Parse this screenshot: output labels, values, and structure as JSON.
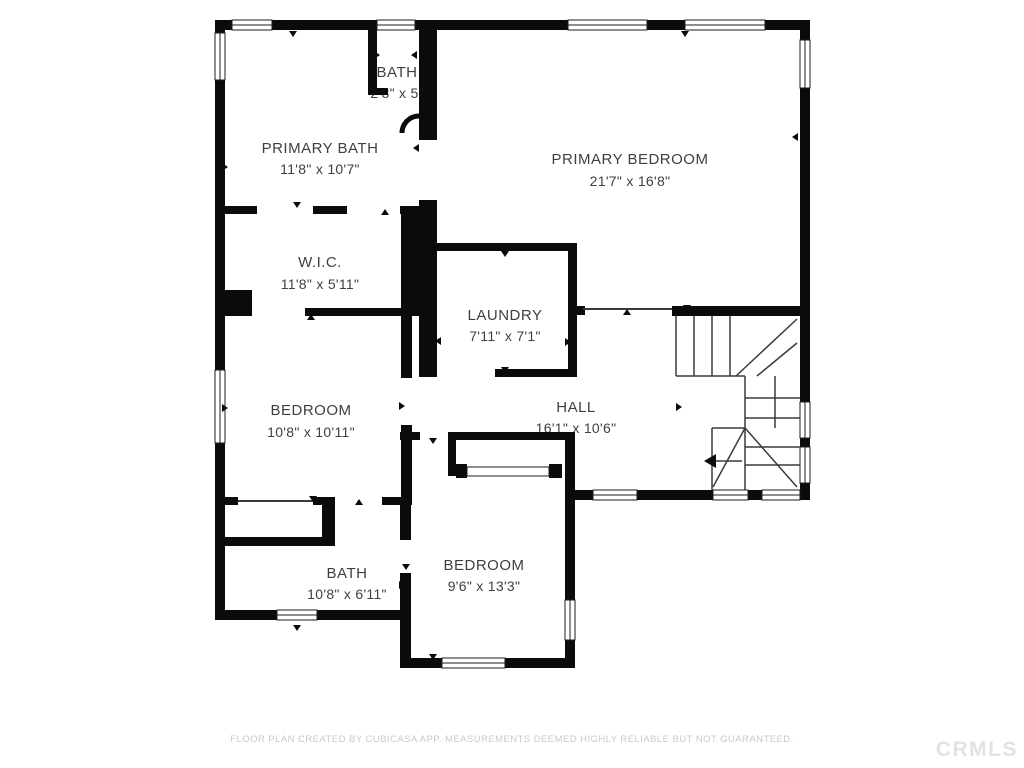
{
  "floor_plan": {
    "rooms": [
      {
        "name": "BATH",
        "dims": "2'8\" x 5'"
      },
      {
        "name": "PRIMARY BATH",
        "dims": "11'8\" x 10'7\""
      },
      {
        "name": "PRIMARY BEDROOM",
        "dims": "21'7\" x 16'8\""
      },
      {
        "name": "W.I.C.",
        "dims": "11'8\" x 5'11\""
      },
      {
        "name": "LAUNDRY",
        "dims": "7'11\" x 7'1\""
      },
      {
        "name": "BEDROOM",
        "dims": "10'8\" x 10'11\""
      },
      {
        "name": "HALL",
        "dims": "16'1\" x 10'6\""
      },
      {
        "name": "BATH",
        "dims": "10'8\" x 6'11\""
      },
      {
        "name": "BEDROOM",
        "dims": "9'6\" x 13'3\""
      }
    ],
    "colors": {
      "wall": "#0b0b0b",
      "line": "#3b3b3b",
      "label_text": "#3f3f3f",
      "footer_text": "#c9c9c9",
      "watermark_text": "#e2e2e2",
      "background": "#ffffff"
    },
    "footer": {
      "disclaimer": "FLOOR PLAN CREATED BY CUBICASA APP. MEASUREMENTS DEEMED HIGHLY RELIABLE BUT NOT GUARANTEED.",
      "watermark": "CRMLS"
    }
  }
}
